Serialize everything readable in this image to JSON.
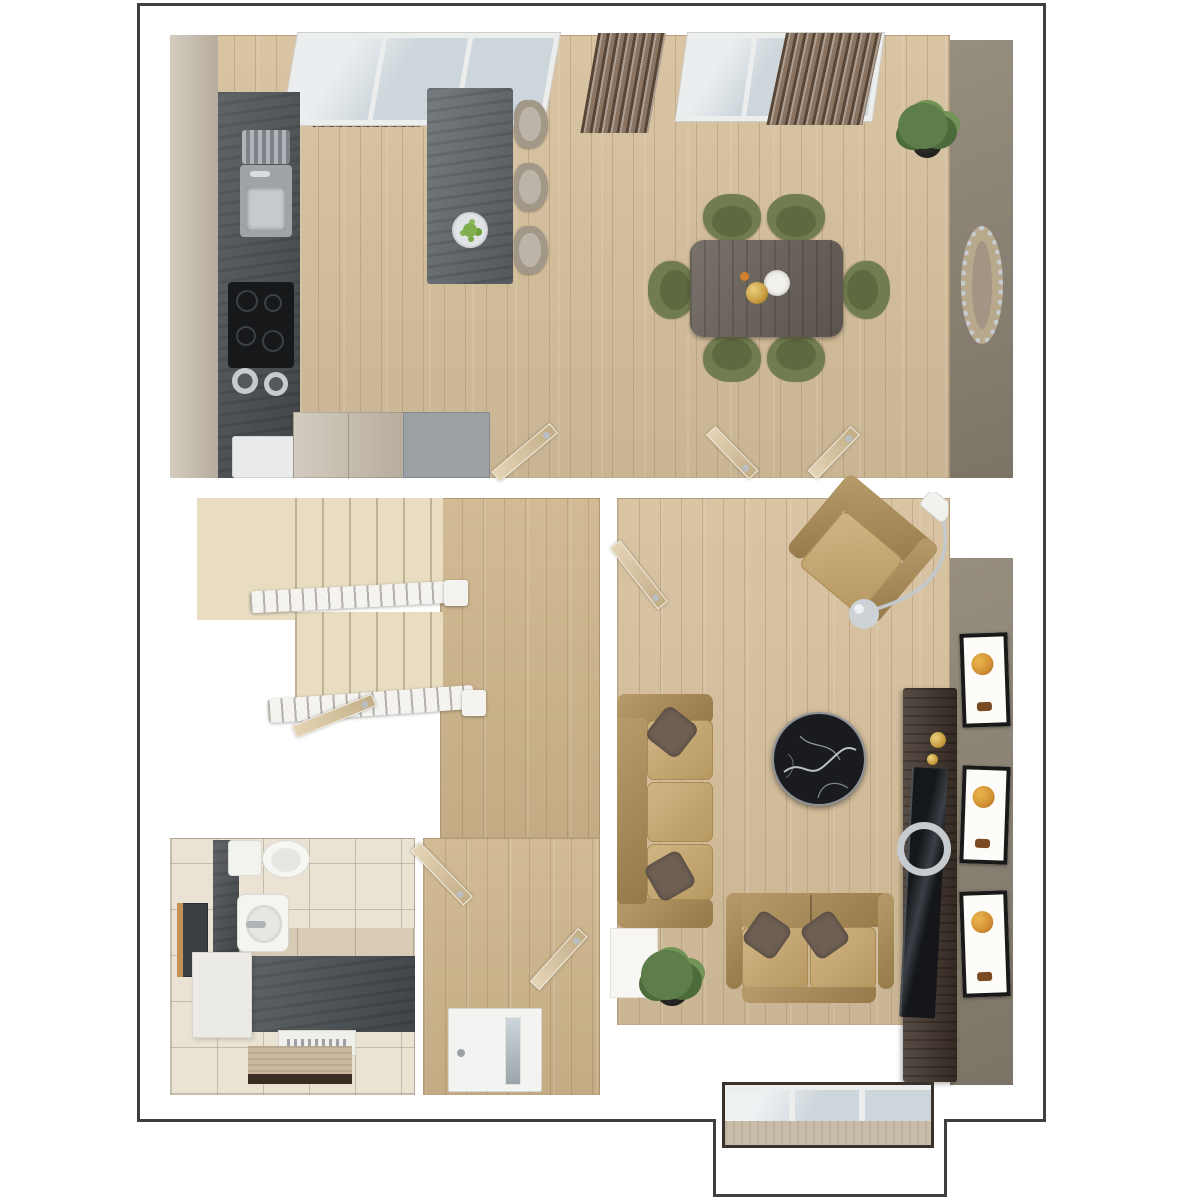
{
  "scene": {
    "type": "3d-floor-plan-render",
    "floor": "ground-floor",
    "rooms": [
      {
        "id": "kitchen-dining",
        "items": [
          "corner-windows",
          "curtain-panels",
          "tall-cabinets",
          "worktop",
          "sink",
          "hob",
          "saucepans",
          "appliance",
          "base-cabinets",
          "kitchen-island",
          "fruit-bowl",
          "bar-stools",
          "dining-table",
          "dining-chairs",
          "gold-vase",
          "flowers",
          "potted-plant",
          "feature-wall",
          "oval-mirror",
          "open-doors"
        ]
      },
      {
        "id": "hall",
        "items": [
          "staircase",
          "landing",
          "stair-railings",
          "newel-posts",
          "open-doors",
          "front-door"
        ]
      },
      {
        "id": "bathroom",
        "items": [
          "toilet",
          "basin",
          "wall-mirror",
          "bath-panel",
          "vanity-top",
          "storage-box",
          "floor-vent",
          "bath-mat",
          "open-door"
        ]
      },
      {
        "id": "living-room",
        "items": [
          "sofa-three-seat",
          "loveseat",
          "cushions",
          "marble-coffee-table",
          "armchair",
          "arc-floor-lamp",
          "media-console",
          "tv",
          "picture-frames",
          "potted-plant",
          "feature-wall",
          "bay-window",
          "open-door"
        ]
      }
    ]
  },
  "counts": {
    "dining_chairs": 6,
    "bar_stools": 3,
    "picture_frames": 3,
    "sofas": 3,
    "open_door_leaves": 7,
    "potted_plants": 2,
    "windows": 3
  },
  "palette": {
    "outline": "#3f3f3f",
    "wood": "#d6c09c",
    "wood2": "#cfb68c",
    "cabinet": "#c2b8a7",
    "counter": "#575c61",
    "island": "#666c71",
    "slate": "#4e5357",
    "tile": "#eae3d3",
    "carpet": "#e8dcc1",
    "railing": "#f4f3ef",
    "feature": "#8d8474",
    "curtain": "#8a7563",
    "glass": "#cdd6db",
    "door": "#d9c196",
    "table": "#675f56",
    "olive": "#727d4f",
    "olivedk": "#5e6940",
    "stool": "#a29888",
    "sofa": "#c6a569",
    "sofadk": "#ab8a52",
    "pillow": "#6e5f53",
    "tableblack": "#191b1e",
    "console": "#40342b",
    "framebk": "#191919",
    "artor": "#d29033",
    "plant": "#5d7d4a",
    "plant2": "#4c6b3a",
    "plant3": "#729457",
    "pot": "#22211f",
    "gold": "#c79c3e",
    "chrome": "#c6cbcf",
    "vanity": "#d8cbb5",
    "sill": "#c9bca9",
    "appliance_gray": "#9ba1a5",
    "appliance_white": "#e9ebeb"
  }
}
